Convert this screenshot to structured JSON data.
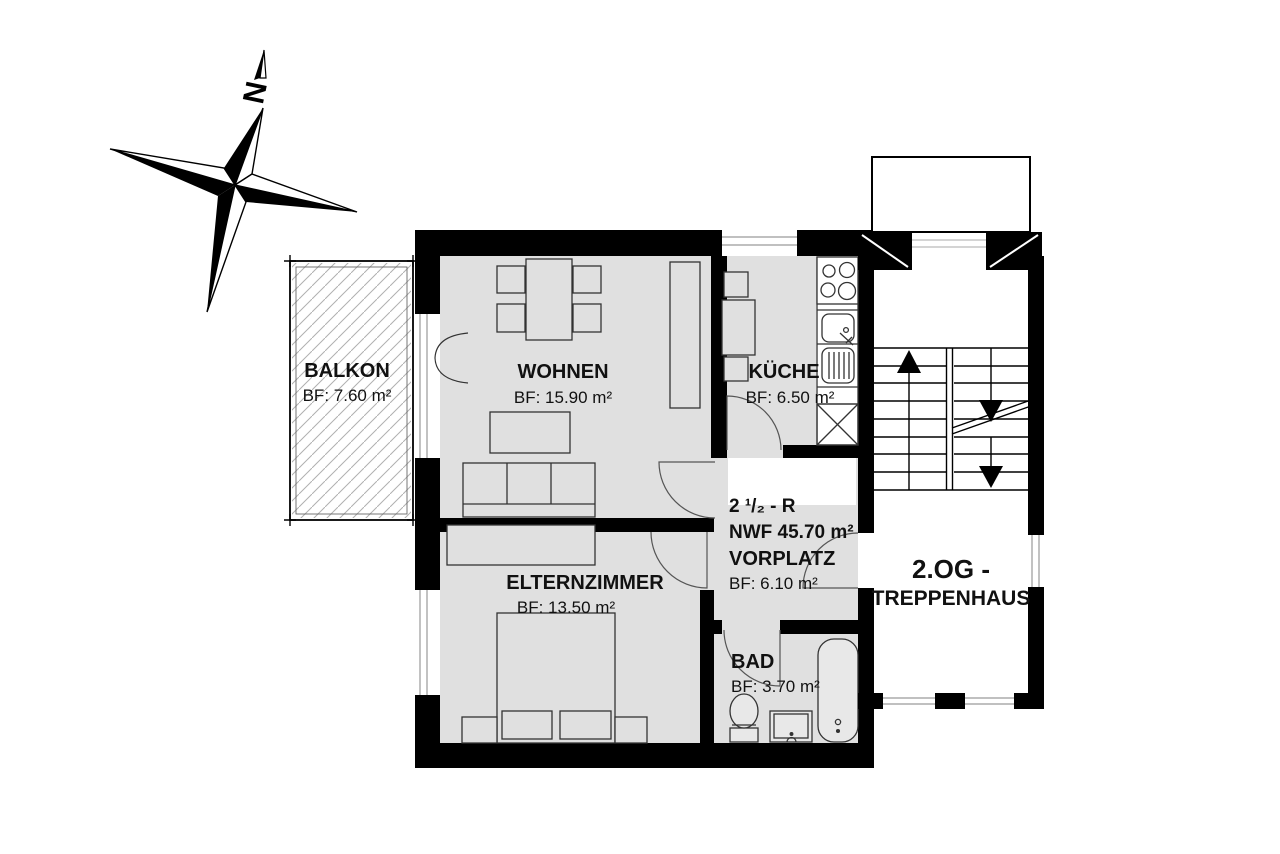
{
  "compass": {
    "north_label": "N"
  },
  "rooms": {
    "balkon": {
      "name": "BALKON",
      "area": "BF: 7.60 m²"
    },
    "wohnen": {
      "name": "WOHNEN",
      "area": "BF: 15.90 m²"
    },
    "kueche": {
      "name": "KÜCHE",
      "area": "BF: 6.50 m²"
    },
    "elternzimmer": {
      "name": "ELTERNZIMMER",
      "area": "BF: 13.50 m²"
    },
    "bad": {
      "name": "BAD",
      "area": "BF: 3.70 m²"
    },
    "vorplatz": {
      "name": "VORPLATZ",
      "area": "BF: 6.10 m²"
    }
  },
  "unit": {
    "type_label": "2 ¹/₂ - R",
    "nwf_label": "NWF  45.70 m²"
  },
  "staircase": {
    "line1": "2.OG -",
    "line2": "TREPPENHAUS"
  },
  "colors": {
    "background": "#ffffff",
    "floor": "#e0e0e0",
    "wall": "#000000",
    "hatch": "#b0b0b0"
  }
}
